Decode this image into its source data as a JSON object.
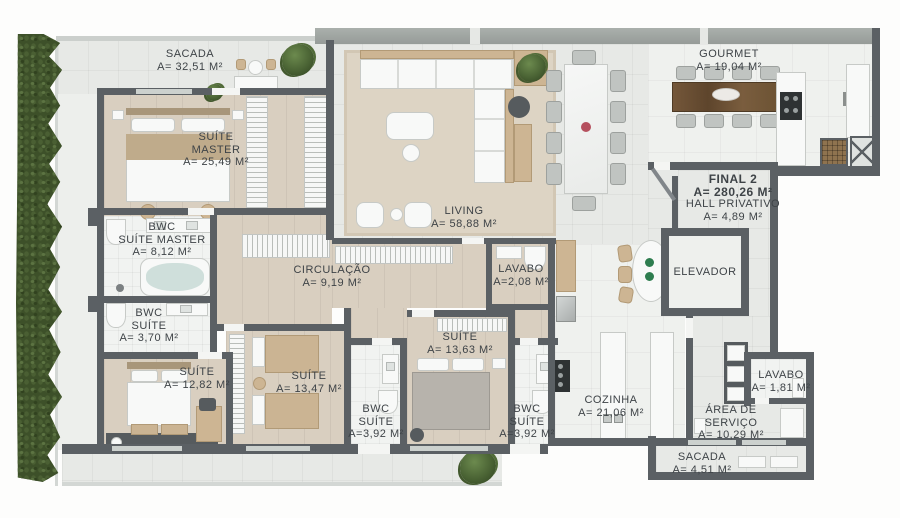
{
  "unit_info": {
    "line1": "FINAL 2",
    "line2": "A= 280,26 M²",
    "line3": "HALL PRIVATIVO",
    "line4": "A= 4,89 M²"
  },
  "rooms": [
    {
      "id": "sacada-top",
      "name": "SACADA",
      "area": "A= 32,51 M²"
    },
    {
      "id": "suite-master",
      "name": "SUÍTE",
      "name2": "MASTER",
      "area": "A= 25,49 M²"
    },
    {
      "id": "bwc-suite-master",
      "name": "BWC",
      "name2": "SUÍTE MASTER",
      "area": "A= 8,12 M²"
    },
    {
      "id": "bwc-suite-small",
      "name": "BWC",
      "name2": "SUÍTE",
      "area": "A= 3,70 M²"
    },
    {
      "id": "suite-1282",
      "name": "SUÍTE",
      "area": "A= 12,82 M²"
    },
    {
      "id": "suite-1347",
      "name": "SUÍTE",
      "area": "A= 13,47 M²"
    },
    {
      "id": "circulacao",
      "name": "CIRCULAÇÃO",
      "area": "A= 9,19 M²"
    },
    {
      "id": "living",
      "name": "LIVING",
      "area": "A= 58,88 M²"
    },
    {
      "id": "lavabo-social",
      "name": "LAVABO",
      "area": "A=2,08 M²"
    },
    {
      "id": "suite-1363",
      "name": "SUÍTE",
      "area": "A= 13,63 M²"
    },
    {
      "id": "bwc-suite-left",
      "name": "BWC",
      "name2": "SUÍTE",
      "area": "A=3,92 M²"
    },
    {
      "id": "bwc-suite-right",
      "name": "BWC",
      "name2": "SUÍTE",
      "area": "A=3,92 M²"
    },
    {
      "id": "gourmet",
      "name": "GOURMET",
      "area": "A= 19,04 M²"
    },
    {
      "id": "elevador",
      "name": "ELEVADOR"
    },
    {
      "id": "cozinha",
      "name": "COZINHA",
      "area": "A= 21,06 M²"
    },
    {
      "id": "area-servico",
      "name": "ÁREA DE",
      "name2": "SERVIÇO",
      "area": "A= 10,29 M²"
    },
    {
      "id": "lavabo-servico",
      "name": "LAVABO",
      "area": "A= 1,81 M²"
    },
    {
      "id": "sacada-bottom",
      "name": "SACADA",
      "area": "A= 4,51 M²"
    }
  ],
  "palette": {
    "wall": "#5b6064",
    "wood_floor": "#d9cfc0",
    "tile_floor": "#e7e9e6",
    "hedge_green": "#3d5029",
    "label_text": "#3e4347",
    "accent_tan": "#cdb593"
  }
}
